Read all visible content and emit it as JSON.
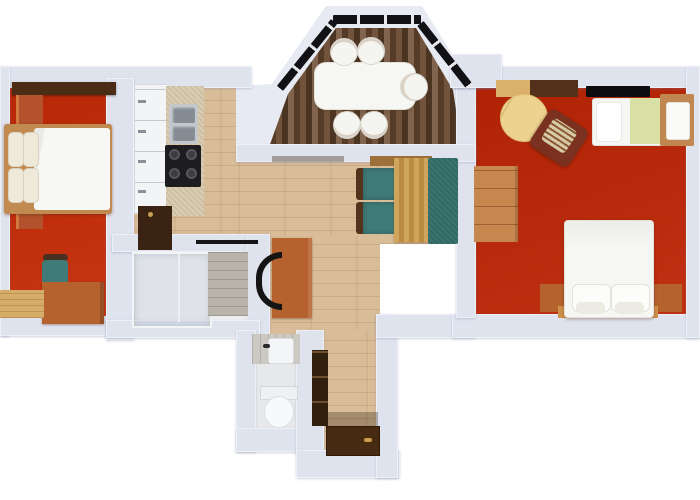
{
  "title": "3D apartment floor plan (top-down render, no text)",
  "colors": {
    "background": "#ffffff",
    "wall": "#dfe3ee",
    "wall_light": "#e7eaf3",
    "floor_red_left": "#c52a06",
    "floor_red_right": "#bd2505",
    "floor_wood": "#d9bc98",
    "floor_wood_dark": "#6b4a31",
    "floor_bath": "#edeff1",
    "floor_wc": "#e7e8ea",
    "tile_gray": "#b8b4ab",
    "tile_wc": "#ccc9c2",
    "window_black": "#121216",
    "teal_chair": "#3f7b78",
    "teal_sofa": "#2f6a66",
    "white_soft": "#f6f6f3",
    "counter": "#d8cbb0",
    "cabinet_white": "#f3f4f6",
    "cabinet_dark": "#3a2312",
    "cooktop_black": "#1d1d20",
    "steel": "#858b93",
    "wood_mid": "#b5622f",
    "wood_light": "#c8874f",
    "wood_pale": "#d6ac69",
    "bed_frame": "#c08a50",
    "wardrobe_orange": "#b3522c",
    "shelf_dark": "#4b2d16",
    "door_brown": "#472a12",
    "handle_gold": "#c9a14e",
    "rug_tan": "#ecd28e",
    "blanket_green": "#d9e0a5",
    "armchair_brown": "#7a3120",
    "tv_black": "#0d0d10"
  },
  "rooms": [
    {
      "id": "bedroom-left",
      "floor": "red",
      "furniture": [
        "wall-shelf",
        "wardrobe",
        "double-bed",
        "pillows-x4",
        "teal-desk-chair",
        "desk",
        "bench"
      ]
    },
    {
      "id": "kitchen",
      "floor": "wood",
      "furniture": [
        "cabinet-row",
        "counter",
        "double-sink",
        "cooktop",
        "dark-base-cabinet"
      ]
    },
    {
      "id": "dining-bay",
      "floor": "dark-wood",
      "furniture": [
        "dining-table",
        "chairs-x5",
        "bay-windows-x3"
      ]
    },
    {
      "id": "living-nook",
      "floor": "wood",
      "furniture": [
        "teal-chairs-x2",
        "plank-table",
        "teal-bench-sofa"
      ]
    },
    {
      "id": "living-bedroom-right",
      "floor": "red",
      "furniture": [
        "console",
        "tv",
        "round-rug",
        "armchair",
        "single-bed",
        "sideboard",
        "double-bed",
        "headboard",
        "nightstand-board"
      ]
    },
    {
      "id": "bathroom",
      "floor": "tile-white",
      "furniture": [
        "glass-shower",
        "stone-tile-wall"
      ]
    },
    {
      "id": "wc",
      "floor": "tile-white",
      "furniture": [
        "hand-sink",
        "toilet"
      ]
    },
    {
      "id": "hallway",
      "floor": "wood",
      "furniture": [
        "wall-shelf",
        "entrance-door"
      ]
    },
    {
      "id": "workspace-corner",
      "floor": "wood",
      "furniture": [
        "desk",
        "office-chair"
      ]
    }
  ]
}
